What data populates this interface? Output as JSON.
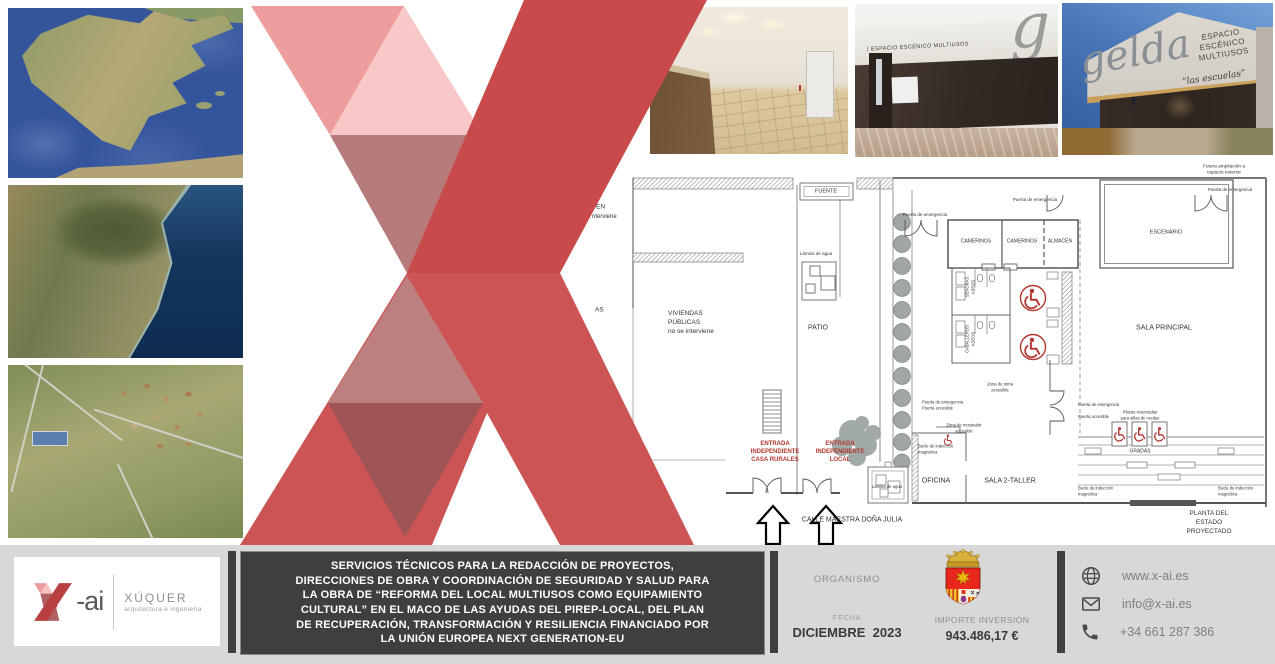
{
  "maps": [
    {
      "name": "satellite-view-iberian-peninsula"
    },
    {
      "name": "satellite-view-coastline"
    },
    {
      "name": "aerial-view-town"
    }
  ],
  "photos": [
    {
      "name": "interior-hall-with-counter"
    },
    {
      "name": "facade-main-entrance",
      "sign_text": "| ESPACIO ESCÉNICO MULTIUSOS",
      "big_letter": "g"
    },
    {
      "name": "building-corner-view",
      "script_text": "gelda",
      "sign_lines": "ESPACIO\nESCÉNICO\nMULTIUSOS",
      "subtitle": "“las escuelas”"
    }
  ],
  "floor_plan": {
    "caption": "PLANTA DEL ESTADO PROYECTADO",
    "labels": [
      {
        "t": "FUENTE",
        "x": 196,
        "y": 27,
        "fs": 5.5
      },
      {
        "t": "Puerta de emergencia",
        "x": 295,
        "y": 50,
        "fs": 4.5
      },
      {
        "t": "Puerta de emergencia",
        "x": 405,
        "y": 35,
        "fs": 4.5
      },
      {
        "t": "Puerta de emergencia",
        "x": 600,
        "y": 25,
        "fs": 4.5
      },
      {
        "t": "Futura ampliación a espacio exterior",
        "x": 594,
        "y": 6,
        "fs": 4.8
      },
      {
        "t": "Lámina de agua",
        "x": 186,
        "y": 89,
        "fs": 4.5
      },
      {
        "t": "VIVIENDAS\nPÚBLICAS\nno se interviene",
        "x": 38,
        "y": 158,
        "fs": 6.5,
        "a": "l"
      },
      {
        "t": "PATIO",
        "x": 188,
        "y": 163,
        "fs": 7
      },
      {
        "t": "CAMERINOS",
        "x": 346,
        "y": 77,
        "fs": 5
      },
      {
        "t": "CAMERINOS",
        "x": 392,
        "y": 77,
        "fs": 5
      },
      {
        "t": "ALMACÉN",
        "x": 430,
        "y": 77,
        "fs": 5
      },
      {
        "t": "ESCENARIO",
        "x": 536,
        "y": 68,
        "fs": 5.5
      },
      {
        "t": "SALA PRINCIPAL",
        "x": 534,
        "y": 163,
        "fs": 7
      },
      {
        "t": "SEÑORAS\nASEOS",
        "x": 340,
        "y": 122,
        "fs": 4.2,
        "r": -90
      },
      {
        "t": "CABALLEROS\nASEOS",
        "x": 340,
        "y": 174,
        "fs": 4.2,
        "r": -90
      },
      {
        "t": "Zona de toma\naccesible",
        "x": 370,
        "y": 222,
        "fs": 4.2
      },
      {
        "t": "Puerta de emergencia\nPuerta accesible",
        "x": 292,
        "y": 240,
        "fs": 4.2,
        "a": "l"
      },
      {
        "t": "Zona de mostrador\naccesible",
        "x": 334,
        "y": 263,
        "fs": 4.2
      },
      {
        "t": "Bucle de inducción\nmagnética",
        "x": 288,
        "y": 284,
        "fs": 4.2,
        "a": "l"
      },
      {
        "t": "OFICINA",
        "x": 306,
        "y": 316,
        "fs": 7
      },
      {
        "t": "SALA 2-TALLER",
        "x": 380,
        "y": 316,
        "fs": 7
      },
      {
        "t": "ENTRADA\nINDEPENDIENTE\nCASA RURALES",
        "x": 145,
        "y": 287,
        "fs": 6,
        "c": "#b33630",
        "b": 1
      },
      {
        "t": "ENTRADA\nINDEPENDIENTE\nLOCAL",
        "x": 210,
        "y": 287,
        "fs": 6,
        "c": "#b33630",
        "b": 1
      },
      {
        "t": "CALLE MAESTRA DOÑA JULIA",
        "x": 222,
        "y": 355,
        "fs": 7
      },
      {
        "t": "Lámina de agua",
        "x": 257,
        "y": 322,
        "fs": 4.2
      },
      {
        "t": "Puerta de emergencia",
        "x": 448,
        "y": 240,
        "fs": 4.2,
        "a": "l"
      },
      {
        "t": "Puerta accesible",
        "x": 448,
        "y": 252,
        "fs": 4.2,
        "a": "l"
      },
      {
        "t": "Plazas reservadas\npara sillas de ruedas",
        "x": 510,
        "y": 250,
        "fs": 4.2
      },
      {
        "t": "GRADAS",
        "x": 510,
        "y": 287,
        "fs": 5
      },
      {
        "t": "Bucle de inducción\nmagnética",
        "x": 448,
        "y": 326,
        "fs": 4.2,
        "a": "l"
      },
      {
        "t": "Bucle de inducción\nmagnética",
        "x": 588,
        "y": 326,
        "fs": 4.2,
        "a": "l"
      },
      {
        "t": "PLANTA DEL ESTADO PROYECTADO",
        "x": 579,
        "y": 358,
        "fs": 6.5
      },
      {
        "t": "EN",
        "x": -34,
        "y": 43,
        "fs": 6.5,
        "a": "l"
      },
      {
        "t": "nterviene",
        "x": -38,
        "y": 52,
        "fs": 6,
        "a": "l"
      },
      {
        "t": "AS",
        "x": -35,
        "y": 146,
        "fs": 6.5,
        "a": "l"
      }
    ]
  },
  "footer": {
    "logo": {
      "suffix": "-ai",
      "company": "XÚQUER",
      "tagline": "arquitectura e ingeniería"
    },
    "project_description": "SERVICIOS TÉCNICOS PARA LA REDACCIÓN DE PROYECTOS,\nDIRECCIONES DE OBRA Y COORDINACIÓN DE SEGURIDAD Y SALUD PARA\nLA OBRA DE “REFORMA DEL LOCAL MULTIUSOS COMO EQUIPAMIENTO\nCULTURAL” EN EL MACO DE LAS AYUDAS DEL PIREP-LOCAL, DEL PLAN\nDE RECUPERACIÓN, TRANSFORMACIÓN Y RESILIENCIA FINANCIADO POR\nLA UNIÓN EUROPEA NEXT GENERATION-EU",
    "organismo_label": "ORGANISMO",
    "fecha_label": "FECHA",
    "fecha_value": "DICIEMBRE  2023",
    "importe_label": "IMPORTE INVERSIÓN",
    "importe_value": "943.486,17 €",
    "contact": {
      "web": "www.x-ai.es",
      "email": "info@x-ai.es",
      "phone": "+34 661 287 386"
    }
  },
  "colors": {
    "brand_red": "#c94a4a",
    "plan_red": "#b33630",
    "footer_bar": "#3f3f3f"
  }
}
